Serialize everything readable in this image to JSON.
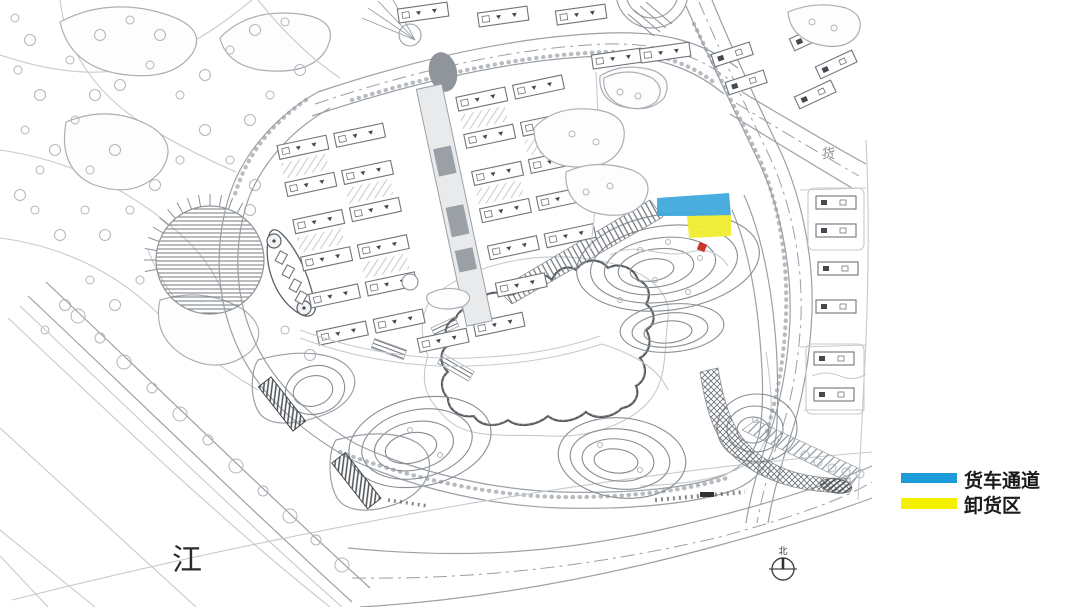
{
  "legend": {
    "items": [
      {
        "label": "货车通道",
        "color": "#1B9BD8"
      },
      {
        "label": "卸货区",
        "color": "#F4F000"
      }
    ]
  },
  "map": {
    "labels": {
      "river": "江",
      "road": "货",
      "north": "北"
    },
    "highlights": {
      "truck_channel_color": "#3AA7DC",
      "unloading_area_color": "#F0EC30",
      "marker_color": "#C83A2E"
    }
  }
}
